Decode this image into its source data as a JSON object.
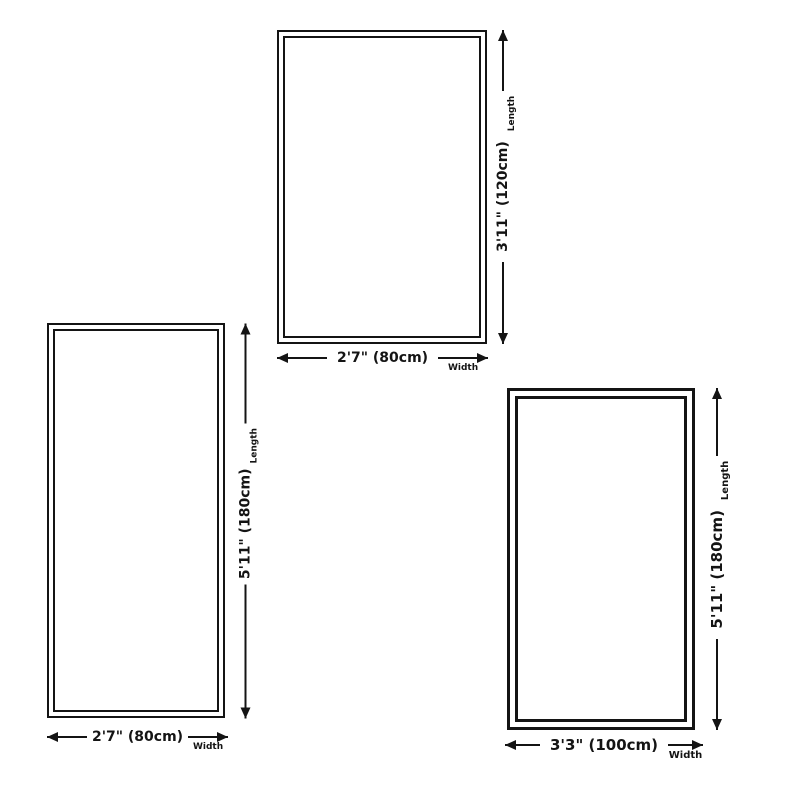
{
  "colors": {
    "background": "#ffffff",
    "line": "#141414"
  },
  "diagrams": [
    {
      "name": "rug-2ft7-by-3ft11",
      "length_label": "3'11\" (120cm)",
      "width_label": "2'7\" (80cm)",
      "length_caption": "Length",
      "width_caption": "Width"
    },
    {
      "name": "rug-2ft7-by-5ft11",
      "length_label": "5'11\" (180cm)",
      "width_label": "2'7\" (80cm)",
      "length_caption": "Length",
      "width_caption": "Width"
    },
    {
      "name": "rug-3ft3-by-5ft11",
      "length_label": "5'11\" (180cm)",
      "width_label": "3'3\" (100cm)",
      "length_caption": "Length",
      "width_caption": "Width"
    }
  ]
}
